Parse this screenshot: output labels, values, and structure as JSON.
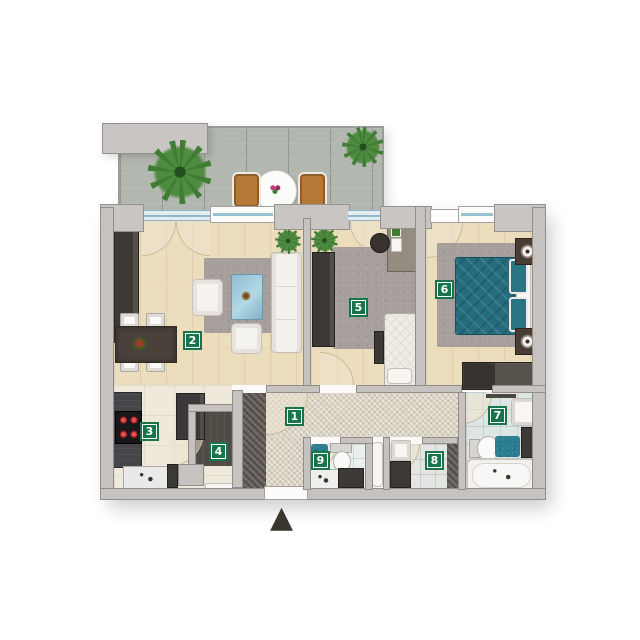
{
  "floorplan": {
    "rooms": [
      {
        "number": "1"
      },
      {
        "number": "2"
      },
      {
        "number": "3"
      },
      {
        "number": "4"
      },
      {
        "number": "5"
      },
      {
        "number": "6"
      },
      {
        "number": "7"
      },
      {
        "number": "8"
      },
      {
        "number": "9"
      }
    ],
    "entrance_marker": "▲",
    "colors": {
      "label_green": "#177549",
      "teal_accent": "#256d7e",
      "glass_blue": "#97c0d3",
      "wall_grey": "#c6c2bf",
      "wood_floor": "#ecddbd",
      "balcony_tile": "#b2b7af",
      "rug_grey": "#a79f9b"
    },
    "icons": {
      "entrance_marker": "triangle-up",
      "plants": "potted-plant",
      "cooktop": "four-burner-hob"
    }
  }
}
